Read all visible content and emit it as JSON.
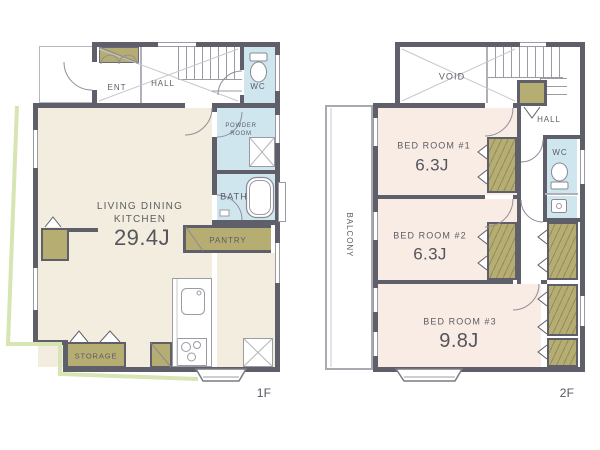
{
  "colors": {
    "wall": "#5f5f6a",
    "living_floor": "#f2edde",
    "bedroom_floor": "#f9ece4",
    "wet_area_floor": "#cfe6ef",
    "cabinet": "#b6ad72",
    "site_line": "#d6e5b3",
    "text": "#5c5c66"
  },
  "floor1": {
    "label": "1F",
    "rooms": {
      "ent": "ENT",
      "hall": "HALL",
      "wc": "WC",
      "powder_line1": "POWDER",
      "powder_line2": "ROOM",
      "bath": "BATH",
      "ldk_line1": "LIVING DINING",
      "ldk_line2": "KITCHEN",
      "ldk_size": "29.4J",
      "pantry": "PANTRY",
      "storage": "STORAGE"
    }
  },
  "floor2": {
    "label": "2F",
    "rooms": {
      "void": "VOID",
      "hall": "HALL",
      "wc": "WC",
      "bedroom1": "BED ROOM #1",
      "bedroom1_size": "6.3J",
      "bedroom2": "BED ROOM #2",
      "bedroom2_size": "6.3J",
      "bedroom3": "BED ROOM #3",
      "bedroom3_size": "9.8J",
      "balcony": "BALCONY"
    }
  }
}
